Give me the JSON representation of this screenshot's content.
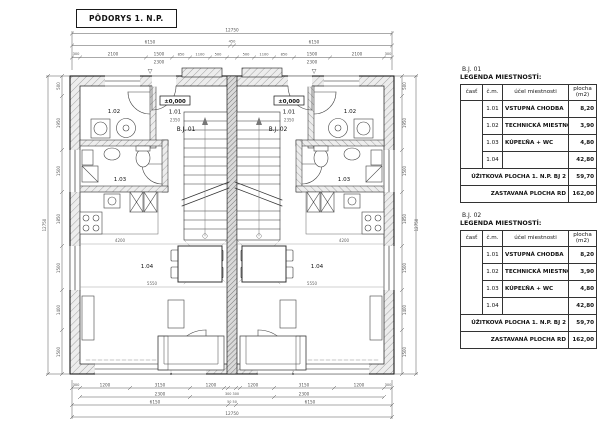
{
  "title": "PÔDORYS 1. N.P.",
  "plan": {
    "entry_marker": "▽",
    "u1": {
      "name": "B.J. 01",
      "level": "±0,000",
      "r101": "1.01",
      "r102": "1.02",
      "r103": "1.03",
      "r104": "1.04",
      "hall_dim": "2350",
      "dim_a": "4200",
      "dim_b": "5550"
    },
    "u2": {
      "name": "B.J. 02",
      "level": "±0,000",
      "r101": "1.01",
      "r102": "1.02",
      "r103": "1.03",
      "r104": "1.04",
      "hall_dim": "2350",
      "dim_a": "4200",
      "dim_b": "5550"
    }
  },
  "dims": {
    "top": {
      "total": "12750",
      "halves": [
        "6150",
        "450",
        "6150"
      ],
      "segments": [
        "300",
        "2100",
        "1500",
        "850",
        "1100",
        "500",
        "500",
        "1100",
        "850",
        "1500",
        "2100",
        "300"
      ],
      "subs": [
        "2300",
        "2300"
      ]
    },
    "bottom": {
      "segments": [
        "300",
        "1200",
        "3150",
        "1200",
        "1200",
        "3150",
        "1200",
        "300"
      ],
      "subs": [
        "2300",
        "300 300",
        "2300"
      ],
      "halves": [
        "6150",
        "50 50",
        "6150"
      ],
      "total": "12750"
    },
    "left": {
      "segments": [
        "500",
        "1950",
        "1500",
        "1850",
        "1500",
        "1400",
        "1500"
      ],
      "total": "12750"
    },
    "right": {
      "segments": [
        "500",
        "1950",
        "1500",
        "1850",
        "1500",
        "1400",
        "1500"
      ],
      "total": "12750"
    }
  },
  "legend": {
    "bj01_label": "B.J. 01",
    "bj02_label": "B.J. 02",
    "title": "LEGENDA MIESTNOSTÍ:",
    "columns": [
      "časť",
      "č.m.",
      "účel miestnosti",
      "plocha",
      "(m2)"
    ],
    "rows": [
      [
        "1.01",
        "VSTUPNÁ CHODBA",
        "8,20"
      ],
      [
        "1.02",
        "TECHNICKÁ MIESTNOSŤ",
        "3,90"
      ],
      [
        "1.03",
        "KÚPEĽŇA + WC",
        "4,80"
      ],
      [
        "1.04",
        "",
        "42,80"
      ]
    ],
    "footer_useful": {
      "label": "ÚŽITKOVÁ PLOCHA 1. N.P. BJ 2",
      "value": "59,70"
    },
    "footer_built": {
      "label": "ZASTAVANÁ PLOCHA RD",
      "value": "162,00"
    }
  }
}
